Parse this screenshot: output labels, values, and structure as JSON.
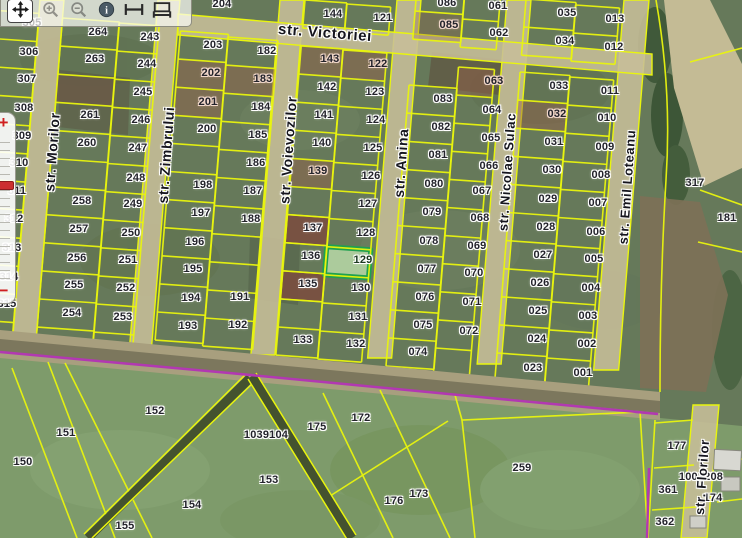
{
  "app": {
    "type": "cadastral-map-viewer"
  },
  "toolbar": {
    "icons": [
      {
        "id": "pan",
        "name": "pan-tool"
      },
      {
        "id": "zoom-in",
        "name": "zoom-in-tool"
      },
      {
        "id": "zoom-out",
        "name": "zoom-out-tool"
      },
      {
        "id": "identify",
        "name": "identify-info-tool"
      },
      {
        "id": "measure-distance",
        "name": "measure-distance-tool"
      },
      {
        "id": "measure-area",
        "name": "measure-area-tool"
      }
    ]
  },
  "zoom_slider": {
    "plus": "+",
    "minus": "−"
  },
  "map": {
    "highlighted_parcel": "129",
    "brown_parcels": [
      "137",
      "135"
    ],
    "tinted_parcels": [
      "202",
      "201",
      "183",
      "143",
      "122",
      "139",
      "063",
      "032",
      "085"
    ],
    "colors": {
      "boundary_yellow": "#e9f50e",
      "highlight_green": "#1ea14f",
      "highlight_fill": "#b9d9a8",
      "road_tan": "#c7be98",
      "selection_purple": "#b238b2",
      "brown_parcel": "#7a4f40",
      "tint_brown": "#96604a"
    },
    "streets": [
      {
        "name": "str. Victoriei",
        "x": 325,
        "y": 33,
        "angle": 4.5,
        "size": 15
      },
      {
        "name": "str. Morilor",
        "x": 52,
        "y": 152,
        "angle": -86,
        "size": 14
      },
      {
        "name": "str. Zimbrului",
        "x": 166,
        "y": 155,
        "angle": -86,
        "size": 14
      },
      {
        "name": "str. Voievozilor",
        "x": 288,
        "y": 150,
        "angle": -86,
        "size": 14
      },
      {
        "name": "str. Anina",
        "x": 401,
        "y": 163,
        "angle": -86,
        "size": 14
      },
      {
        "name": "str. Nicolae Sulac",
        "x": 507,
        "y": 172,
        "angle": -86,
        "size": 13
      },
      {
        "name": "str. Emil Loteanu",
        "x": 627,
        "y": 187,
        "angle": -86,
        "size": 13
      },
      {
        "name": "str. Florilor",
        "x": 702,
        "y": 477,
        "angle": -86,
        "size": 13
      }
    ],
    "parcels": [
      {
        "n": "305",
        "x": 32,
        "y": 23
      },
      {
        "n": "306",
        "x": 29,
        "y": 52
      },
      {
        "n": "307",
        "x": 27,
        "y": 79
      },
      {
        "n": "308",
        "x": 24,
        "y": 108
      },
      {
        "n": "309",
        "x": 22,
        "y": 136
      },
      {
        "n": "310",
        "x": 19,
        "y": 163
      },
      {
        "n": "311",
        "x": 17,
        "y": 191
      },
      {
        "n": "312",
        "x": 14,
        "y": 219
      },
      {
        "n": "313",
        "x": 12,
        "y": 248
      },
      {
        "n": "314",
        "x": 9,
        "y": 277
      },
      {
        "n": "315",
        "x": 7,
        "y": 304
      },
      {
        "n": "264",
        "x": 98,
        "y": 32
      },
      {
        "n": "263",
        "x": 95,
        "y": 59
      },
      {
        "n": "261",
        "x": 90,
        "y": 115
      },
      {
        "n": "260",
        "x": 87,
        "y": 143
      },
      {
        "n": "258",
        "x": 82,
        "y": 201
      },
      {
        "n": "257",
        "x": 79,
        "y": 229
      },
      {
        "n": "256",
        "x": 77,
        "y": 258
      },
      {
        "n": "255",
        "x": 74,
        "y": 285
      },
      {
        "n": "254",
        "x": 72,
        "y": 313
      },
      {
        "n": "243",
        "x": 150,
        "y": 37
      },
      {
        "n": "244",
        "x": 147,
        "y": 64
      },
      {
        "n": "245",
        "x": 143,
        "y": 92
      },
      {
        "n": "246",
        "x": 141,
        "y": 120
      },
      {
        "n": "247",
        "x": 138,
        "y": 148
      },
      {
        "n": "248",
        "x": 136,
        "y": 178
      },
      {
        "n": "249",
        "x": 133,
        "y": 204
      },
      {
        "n": "250",
        "x": 131,
        "y": 233
      },
      {
        "n": "251",
        "x": 128,
        "y": 260
      },
      {
        "n": "252",
        "x": 126,
        "y": 288
      },
      {
        "n": "253",
        "x": 123,
        "y": 317
      },
      {
        "n": "204",
        "x": 222,
        "y": 4
      },
      {
        "n": "203",
        "x": 213,
        "y": 45
      },
      {
        "n": "202",
        "x": 211,
        "y": 73
      },
      {
        "n": "201",
        "x": 208,
        "y": 102
      },
      {
        "n": "200",
        "x": 207,
        "y": 129
      },
      {
        "n": "198",
        "x": 203,
        "y": 185
      },
      {
        "n": "197",
        "x": 201,
        "y": 213
      },
      {
        "n": "196",
        "x": 195,
        "y": 242
      },
      {
        "n": "195",
        "x": 193,
        "y": 269
      },
      {
        "n": "194",
        "x": 191,
        "y": 298
      },
      {
        "n": "193",
        "x": 188,
        "y": 326
      },
      {
        "n": "182",
        "x": 267,
        "y": 51
      },
      {
        "n": "183",
        "x": 263,
        "y": 79
      },
      {
        "n": "184",
        "x": 261,
        "y": 107
      },
      {
        "n": "185",
        "x": 258,
        "y": 135
      },
      {
        "n": "186",
        "x": 256,
        "y": 163
      },
      {
        "n": "187",
        "x": 253,
        "y": 191
      },
      {
        "n": "188",
        "x": 251,
        "y": 219
      },
      {
        "n": "191",
        "x": 240,
        "y": 297
      },
      {
        "n": "192",
        "x": 238,
        "y": 325
      },
      {
        "n": "144",
        "x": 333,
        "y": 14
      },
      {
        "n": "143",
        "x": 330,
        "y": 59
      },
      {
        "n": "142",
        "x": 327,
        "y": 87
      },
      {
        "n": "141",
        "x": 324,
        "y": 115
      },
      {
        "n": "140",
        "x": 322,
        "y": 143
      },
      {
        "n": "139",
        "x": 318,
        "y": 171
      },
      {
        "n": "137",
        "x": 313,
        "y": 228
      },
      {
        "n": "136",
        "x": 311,
        "y": 256
      },
      {
        "n": "135",
        "x": 308,
        "y": 284
      },
      {
        "n": "133",
        "x": 303,
        "y": 340
      },
      {
        "n": "121",
        "x": 383,
        "y": 18
      },
      {
        "n": "122",
        "x": 378,
        "y": 64
      },
      {
        "n": "123",
        "x": 375,
        "y": 92
      },
      {
        "n": "124",
        "x": 376,
        "y": 120
      },
      {
        "n": "125",
        "x": 373,
        "y": 148
      },
      {
        "n": "126",
        "x": 371,
        "y": 176
      },
      {
        "n": "127",
        "x": 368,
        "y": 204
      },
      {
        "n": "128",
        "x": 366,
        "y": 233
      },
      {
        "n": "129",
        "x": 363,
        "y": 260
      },
      {
        "n": "130",
        "x": 361,
        "y": 288
      },
      {
        "n": "131",
        "x": 358,
        "y": 317
      },
      {
        "n": "132",
        "x": 356,
        "y": 344
      },
      {
        "n": "086",
        "x": 447,
        "y": 3
      },
      {
        "n": "085",
        "x": 449,
        "y": 25
      },
      {
        "n": "083",
        "x": 443,
        "y": 99
      },
      {
        "n": "082",
        "x": 441,
        "y": 127
      },
      {
        "n": "081",
        "x": 438,
        "y": 155
      },
      {
        "n": "080",
        "x": 434,
        "y": 184
      },
      {
        "n": "079",
        "x": 432,
        "y": 212
      },
      {
        "n": "078",
        "x": 429,
        "y": 241
      },
      {
        "n": "077",
        "x": 427,
        "y": 269
      },
      {
        "n": "076",
        "x": 425,
        "y": 297
      },
      {
        "n": "075",
        "x": 423,
        "y": 325
      },
      {
        "n": "074",
        "x": 418,
        "y": 352
      },
      {
        "n": "061",
        "x": 498,
        "y": 6
      },
      {
        "n": "062",
        "x": 499,
        "y": 33
      },
      {
        "n": "063",
        "x": 494,
        "y": 81
      },
      {
        "n": "064",
        "x": 492,
        "y": 110
      },
      {
        "n": "065",
        "x": 491,
        "y": 138
      },
      {
        "n": "066",
        "x": 489,
        "y": 166
      },
      {
        "n": "067",
        "x": 482,
        "y": 191
      },
      {
        "n": "068",
        "x": 480,
        "y": 218
      },
      {
        "n": "069",
        "x": 477,
        "y": 246
      },
      {
        "n": "070",
        "x": 474,
        "y": 273
      },
      {
        "n": "071",
        "x": 472,
        "y": 302
      },
      {
        "n": "072",
        "x": 469,
        "y": 331
      },
      {
        "n": "035",
        "x": 567,
        "y": 13
      },
      {
        "n": "034",
        "x": 565,
        "y": 41
      },
      {
        "n": "033",
        "x": 559,
        "y": 86
      },
      {
        "n": "032",
        "x": 557,
        "y": 114
      },
      {
        "n": "031",
        "x": 554,
        "y": 142
      },
      {
        "n": "030",
        "x": 552,
        "y": 170
      },
      {
        "n": "029",
        "x": 548,
        "y": 199
      },
      {
        "n": "028",
        "x": 546,
        "y": 227
      },
      {
        "n": "027",
        "x": 543,
        "y": 255
      },
      {
        "n": "026",
        "x": 540,
        "y": 283
      },
      {
        "n": "025",
        "x": 538,
        "y": 311
      },
      {
        "n": "024",
        "x": 537,
        "y": 339
      },
      {
        "n": "023",
        "x": 533,
        "y": 368
      },
      {
        "n": "013",
        "x": 615,
        "y": 19
      },
      {
        "n": "012",
        "x": 614,
        "y": 47
      },
      {
        "n": "011",
        "x": 610,
        "y": 91
      },
      {
        "n": "010",
        "x": 607,
        "y": 118
      },
      {
        "n": "009",
        "x": 605,
        "y": 147
      },
      {
        "n": "008",
        "x": 601,
        "y": 175
      },
      {
        "n": "007",
        "x": 598,
        "y": 203
      },
      {
        "n": "006",
        "x": 596,
        "y": 232
      },
      {
        "n": "005",
        "x": 594,
        "y": 259
      },
      {
        "n": "004",
        "x": 591,
        "y": 288
      },
      {
        "n": "003",
        "x": 588,
        "y": 316
      },
      {
        "n": "002",
        "x": 587,
        "y": 344
      },
      {
        "n": "001",
        "x": 583,
        "y": 373
      },
      {
        "n": "317",
        "x": 695,
        "y": 183
      },
      {
        "n": "181",
        "x": 727,
        "y": 218
      },
      {
        "n": "152",
        "x": 155,
        "y": 411
      },
      {
        "n": "151",
        "x": 66,
        "y": 433
      },
      {
        "n": "150",
        "x": 23,
        "y": 462
      },
      {
        "n": "153",
        "x": 269,
        "y": 480
      },
      {
        "n": "154",
        "x": 192,
        "y": 505
      },
      {
        "n": "155",
        "x": 125,
        "y": 526
      },
      {
        "n": "175",
        "x": 317,
        "y": 427
      },
      {
        "n": "172",
        "x": 361,
        "y": 418
      },
      {
        "n": "176",
        "x": 394,
        "y": 501
      },
      {
        "n": "173",
        "x": 419,
        "y": 494
      },
      {
        "n": "259",
        "x": 522,
        "y": 468
      },
      {
        "n": "177",
        "x": 677,
        "y": 446
      },
      {
        "n": "361",
        "x": 668,
        "y": 490
      },
      {
        "n": "362",
        "x": 665,
        "y": 522
      },
      {
        "n": "174",
        "x": 713,
        "y": 498
      }
    ],
    "cadastral_numbers": [
      {
        "n": "1039104",
        "x": 266,
        "y": 435
      },
      {
        "n": "1001208",
        "x": 701,
        "y": 477
      }
    ]
  }
}
